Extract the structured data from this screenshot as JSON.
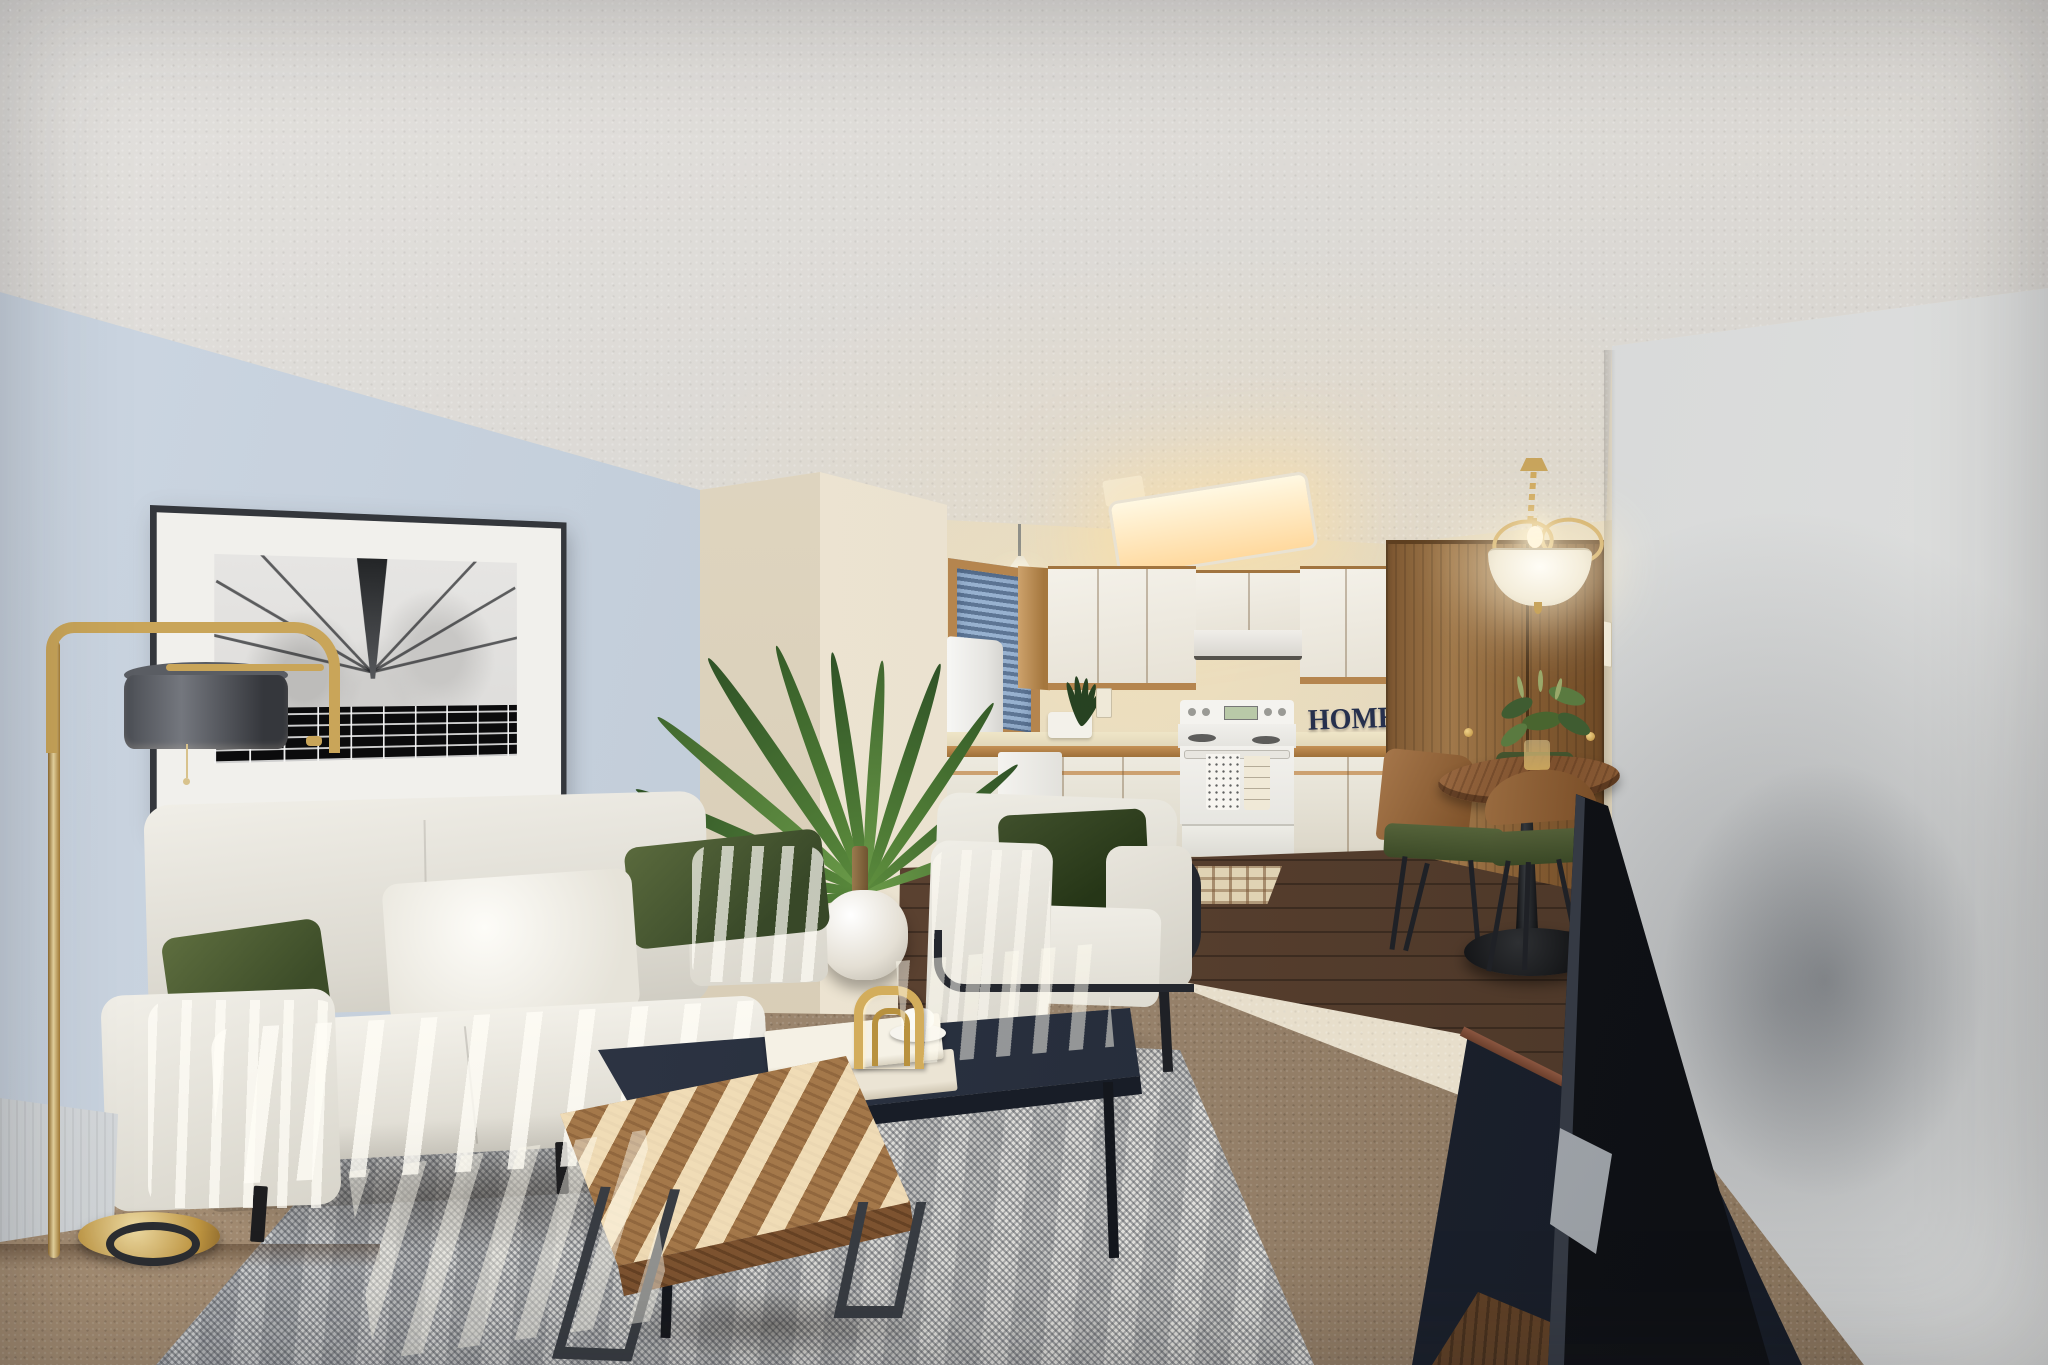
{
  "meta": {
    "domain": "natural-image",
    "description": "Virtually staged real-estate photograph of an open-concept apartment: living room in front, galley kitchen and dining nook in back, textured ceiling, sunlight stripes falling across the furniture.",
    "dimensions": {
      "width_px": 2048,
      "height_px": 1365
    }
  },
  "visible_text": {
    "home_sign": "HOME"
  },
  "palette": {
    "left_wall_blue_grey": "#c4cfdb",
    "right_wall_grey": "#d3d5d6",
    "back_wall_cream": "#e8dfc9",
    "ceiling": "#d9d6d1",
    "cabinet_doors_white": "#f1ede4",
    "oak_trim": "#b5854e",
    "window_blinds_blue": "#8aa6c6",
    "sofa_fabric_cream": "#edebe3",
    "pillow_olive_green": "#44542e",
    "pillow_white": "#f7f5ef",
    "coffee_table_navy": "#2a3240",
    "bench_wood_walnut": "#b68a58",
    "area_rug_grey": "#d4d3cf",
    "carpet_brown": "#97826b",
    "wood_floor_dark": "#5a4130",
    "closet_doors_oak": "#8a6136",
    "dining_chair_green": "#4a5631",
    "tv_black": "#15181d",
    "media_console_navy": "#222834",
    "lamp_brass": "#c9a559",
    "lamp_shade_charcoal": "#4a4d53",
    "home_sign_navy": "#26304d"
  },
  "objects": [
    {
      "name": "framed-artwork",
      "desc": "Black-and-white architectural photo (skyscraper seen from below, radiating lines, clouds, dark grid floor) with wide white mat and thin dark frame, hung on left wall"
    },
    {
      "name": "floor-lamp",
      "desc": "Brass floor lamp with overhanging arm, charcoal drum shade, pull chain and round brass disc base"
    },
    {
      "name": "baseboard-heater",
      "desc": "White electric baseboard heater along the left wall"
    },
    {
      "name": "sofa",
      "desc": "Cream three-seat sofa with black legs, two olive-green pillows, one white pillow, striped with sunlight"
    },
    {
      "name": "palm-plant",
      "desc": "Areca palm in a round white pot between sofa and armchair"
    },
    {
      "name": "armchair",
      "desc": "Cream lounge armchair with exposed black tubular frame and dark green pillow"
    },
    {
      "name": "coffee-table",
      "desc": "Low navy rectangular coffee table holding two cream books, a gold arch sculpture and a white cup with saucer"
    },
    {
      "name": "bench-table",
      "desc": "Light walnut bench/coffee table with dark steel loop legs, diagonal sun stripes"
    },
    {
      "name": "area-rug",
      "desc": "Large grey-white woven rug over brown wall-to-wall carpet"
    },
    {
      "name": "kitchen",
      "desc": "White cabinets with oak trim, white fridge, window with blue blinds, pendant light, fluorescent ceiling light, range hood, white electric stove with two tea towels, dishwasher, faucet, plaid floor mat, dark green counter plant, navy HOME letter sign"
    },
    {
      "name": "dining-set",
      "desc": "Round wood pedestal table with black tulip base, green-seat wood chairs, glass vase with greenery, brass chandelier with frosted glass bowl"
    },
    {
      "name": "closet",
      "desc": "Double oak closet doors with brass knobs in dining nook"
    },
    {
      "name": "tv-and-console",
      "desc": "Flat-screen TV seen edge-on on a silver stand atop a navy media console with walnut base, along right wall"
    }
  ]
}
